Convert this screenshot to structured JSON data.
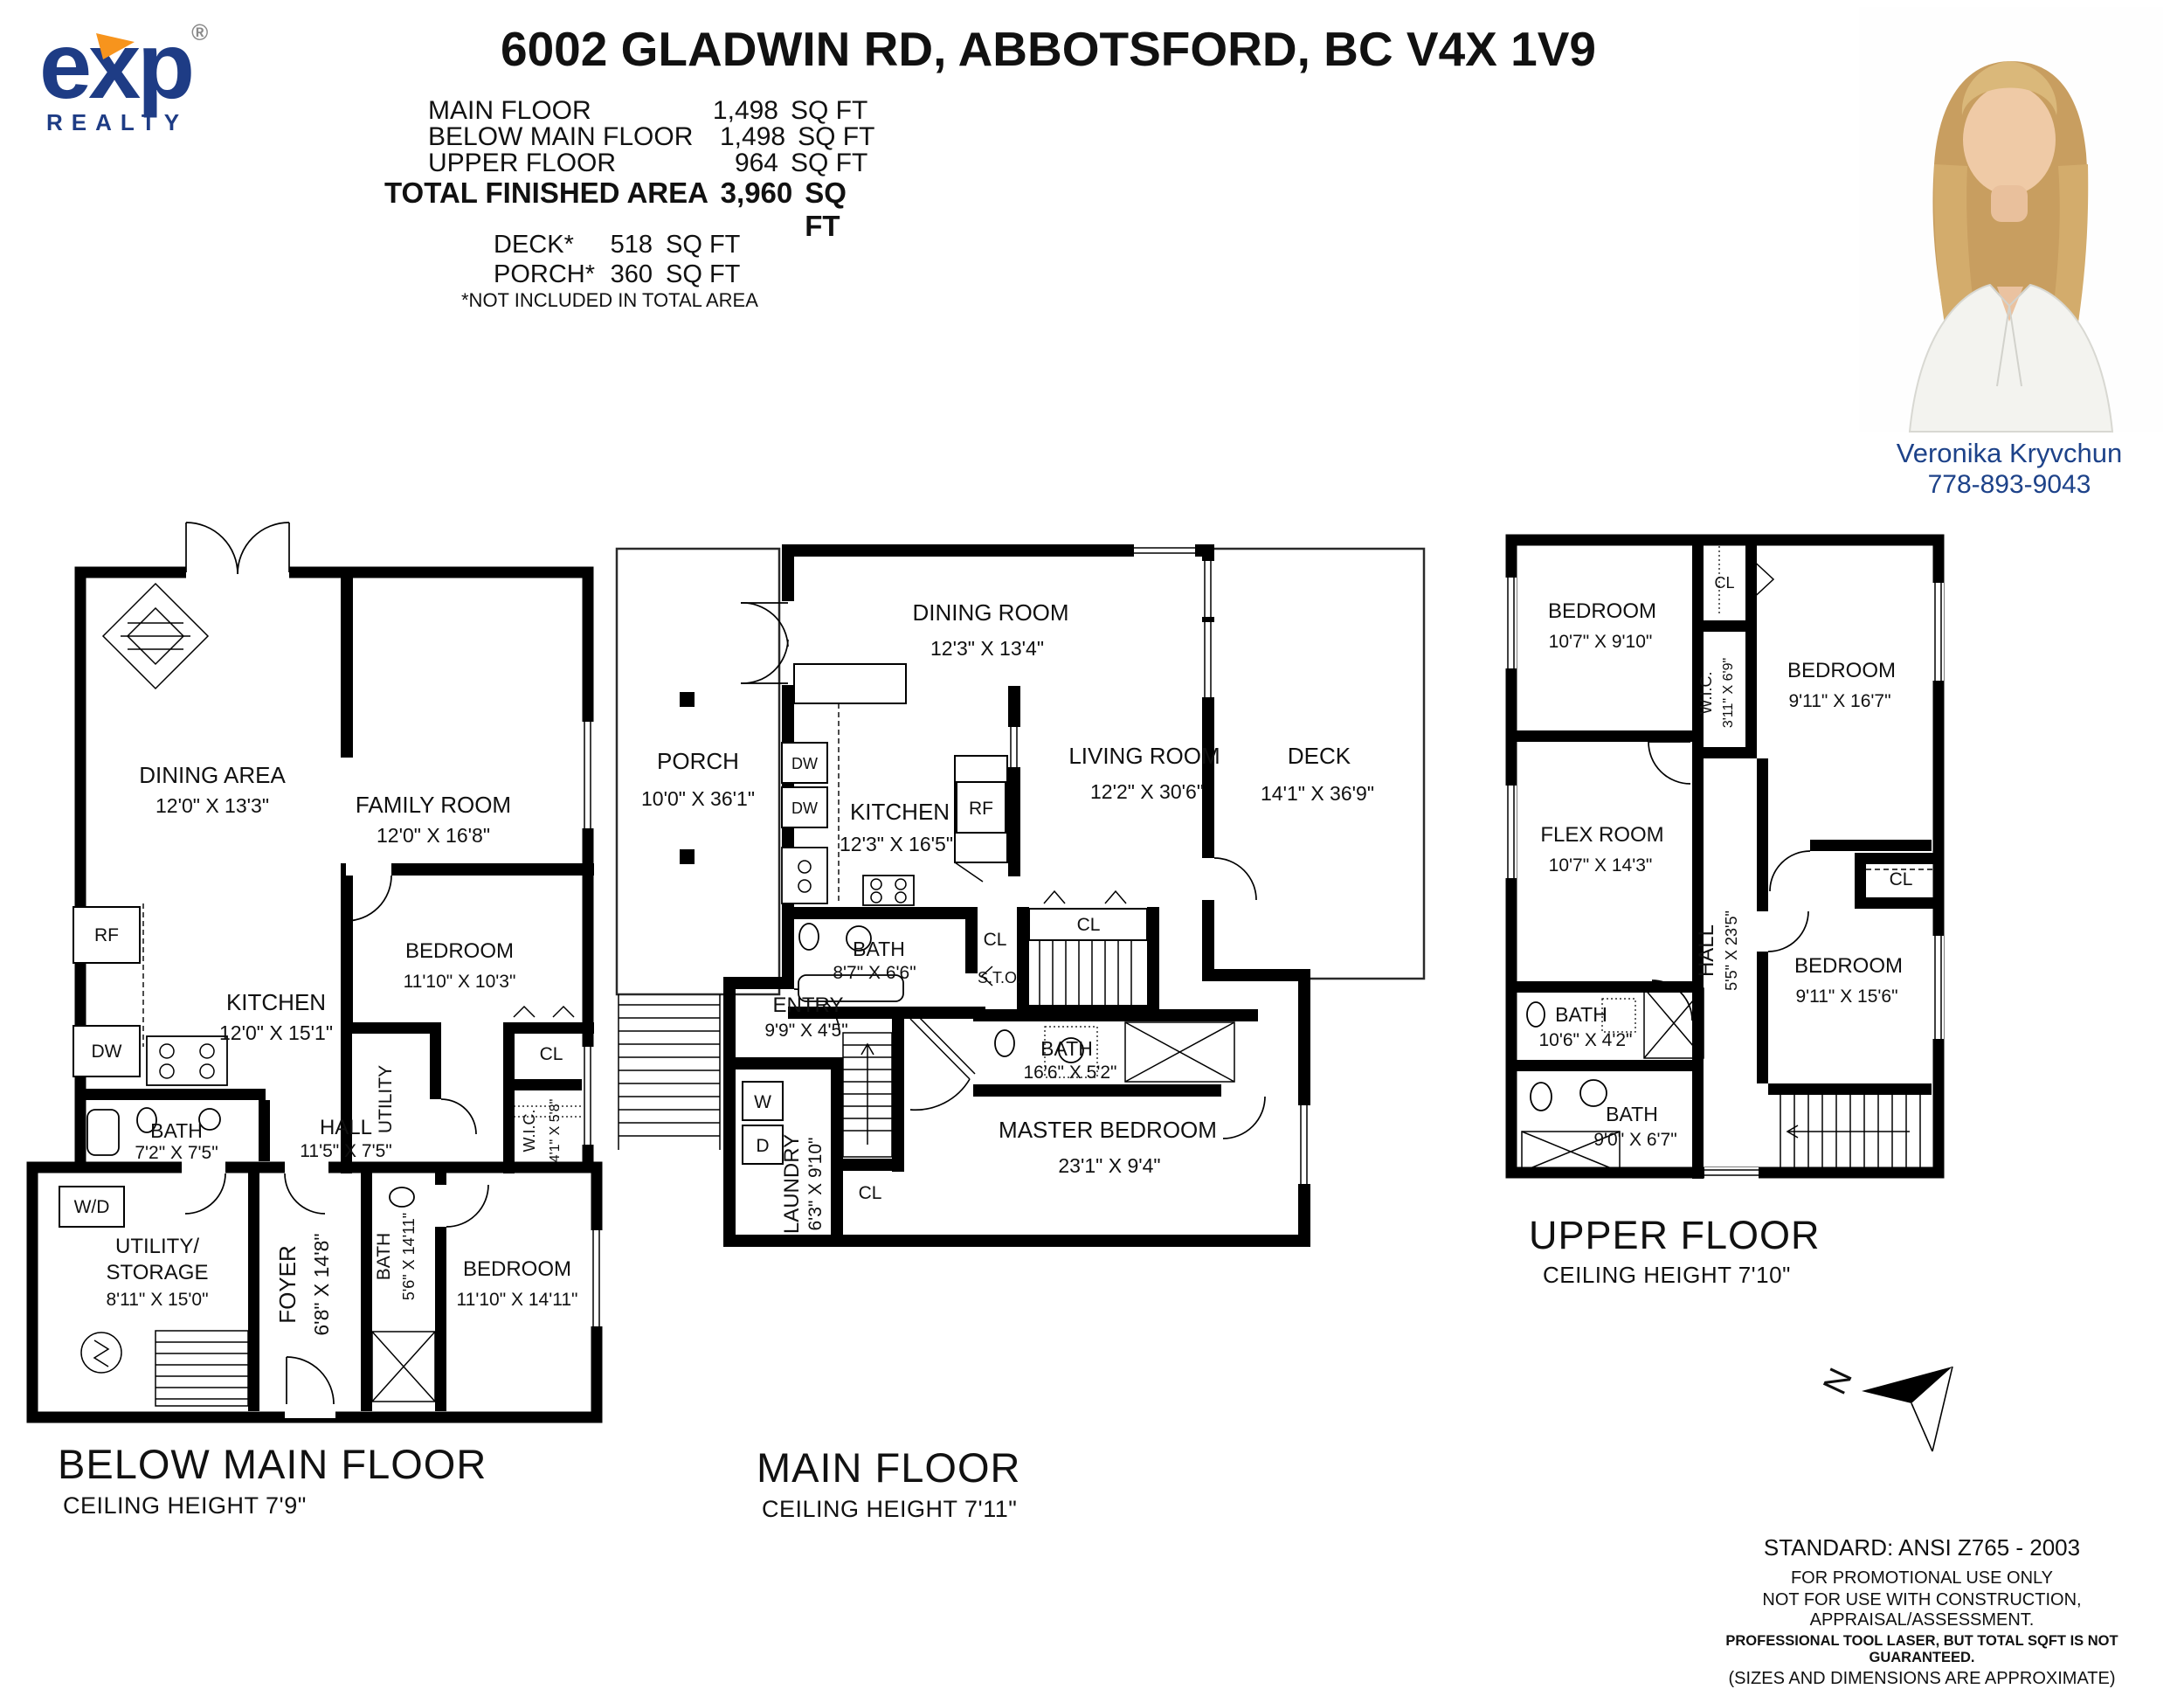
{
  "header": {
    "title": "6002 GLADWIN RD, ABBOTSFORD, BC V4X 1V9",
    "logo": {
      "e": "e",
      "x": "x",
      "p": "p",
      "reg": "®",
      "realty": "REALTY",
      "navy": "#1e3c85",
      "orange": "#f7941d"
    },
    "areas": [
      {
        "label": "MAIN FLOOR",
        "value": "1,498",
        "unit": "SQ FT"
      },
      {
        "label": "BELOW MAIN FLOOR",
        "value": "1,498",
        "unit": "SQ FT"
      },
      {
        "label": "UPPER FLOOR",
        "value": "964",
        "unit": "SQ FT"
      }
    ],
    "total": {
      "label": "TOTAL FINISHED AREA",
      "value": "3,960",
      "unit": "SQ FT"
    },
    "extras": [
      {
        "label": "DECK*",
        "value": "518",
        "unit": "SQ FT"
      },
      {
        "label": "PORCH*",
        "value": "360",
        "unit": "SQ FT"
      }
    ],
    "note": "*NOT INCLUDED IN TOTAL AREA"
  },
  "agent": {
    "name": "Veronika Kryvchun",
    "phone": "778-893-9043",
    "text_color": "#1d4289"
  },
  "floors": {
    "below": {
      "title": "BELOW MAIN FLOOR",
      "ceiling": "CEILING HEIGHT   7'9\"",
      "rooms": {
        "dining": {
          "name": "DINING AREA",
          "dims": "12'0\" X 13'3\""
        },
        "family": {
          "name": "FAMILY ROOM",
          "dims": "12'0\" X 16'8\""
        },
        "kitchen": {
          "name": "KITCHEN",
          "dims": "12'0\" X 15'1\""
        },
        "bedroom1": {
          "name": "BEDROOM",
          "dims": "11'10\" X 10'3\""
        },
        "bath1": {
          "name": "BATH",
          "dims": "7'2\" X 7'5\""
        },
        "hall": {
          "name": "HALL",
          "dims": "11'5\" X 7'5\""
        },
        "utility": {
          "name": "UTILITY"
        },
        "cl": {
          "name": "CL"
        },
        "wic": {
          "name": "W.I.C.",
          "dims": "4'1\" X 5'8\""
        },
        "wd": {
          "name": "W/D"
        },
        "storage": {
          "line1": "UTILITY/",
          "line2": "STORAGE",
          "dims": "8'11\" X 15'0\""
        },
        "foyer": {
          "name": "FOYER",
          "dims": "6'8\" X 14'8\""
        },
        "bath2": {
          "name": "BATH",
          "dims": "5'6\" X 14'11\""
        },
        "bedroom2": {
          "name": "BEDROOM",
          "dims": "11'10\" X 14'11\""
        },
        "rf": {
          "name": "RF"
        },
        "dw": {
          "name": "DW"
        }
      }
    },
    "main": {
      "title": "MAIN FLOOR",
      "ceiling": "CEILING HEIGHT   7'11\"",
      "rooms": {
        "porch": {
          "name": "PORCH",
          "dims": "10'0\" X 36'1\""
        },
        "dining": {
          "name": "DINING ROOM",
          "dims": "12'3\" X 13'4\""
        },
        "kitchen": {
          "name": "KITCHEN",
          "dims": "12'3\" X 16'5\""
        },
        "living": {
          "name": "LIVING ROOM",
          "dims": "12'2\" X 30'6\""
        },
        "deck": {
          "name": "DECK",
          "dims": "14'1\" X 36'9\""
        },
        "bath1": {
          "name": "BATH",
          "dims": "8'7\" X 6'6\""
        },
        "cl1": {
          "name": "CL"
        },
        "cl2": {
          "name": "CL"
        },
        "cl3": {
          "name": "CL"
        },
        "sto": {
          "name": "S.T.O."
        },
        "entry": {
          "name": "ENTRY",
          "dims": "9'9\" X 4'5\""
        },
        "laundry": {
          "name": "LAUNDRY",
          "dims": "6'3\" X 9'10\""
        },
        "w": {
          "name": "W"
        },
        "d": {
          "name": "D"
        },
        "bath2": {
          "name": "BATH",
          "dims": "16'6\" X 5'2\""
        },
        "master": {
          "name": "MASTER BEDROOM",
          "dims": "23'1\" X 9'4\""
        },
        "dw1": {
          "name": "DW"
        },
        "dw2": {
          "name": "DW"
        },
        "rf": {
          "name": "RF"
        }
      }
    },
    "upper": {
      "title": "UPPER FLOOR",
      "ceiling": "CEILING HEIGHT   7'10\"",
      "rooms": {
        "bedroom1": {
          "name": "BEDROOM",
          "dims": "10'7\" X 9'10\""
        },
        "cl1": {
          "name": "CL"
        },
        "wic": {
          "name": "W.I.C.",
          "dims": "3'11\" X 6'9\""
        },
        "bedroom2": {
          "name": "BEDROOM",
          "dims": "9'11\" X 16'7\""
        },
        "flex": {
          "name": "FLEX ROOM",
          "dims": "10'7\" X 14'3\""
        },
        "hall": {
          "name": "HALL",
          "dims": "5'5\" X 23'5\""
        },
        "cl2": {
          "name": "CL"
        },
        "bath1": {
          "name": "BATH",
          "dims": "10'6\" X 4'2\""
        },
        "bath2": {
          "name": "BATH",
          "dims": "9'0\" X 6'7\""
        },
        "bedroom3": {
          "name": "BEDROOM",
          "dims": "9'11\" X 15'6\""
        }
      }
    }
  },
  "compass": {
    "label": "N"
  },
  "disclaimer": {
    "line1": "STANDARD: ANSI  Z765 - 2003",
    "line2": "FOR PROMOTIONAL USE ONLY",
    "line3": "NOT FOR USE WITH CONSTRUCTION, APPRAISAL/ASSESSMENT.",
    "line4": "PROFESSIONAL TOOL LASER, BUT TOTAL SQFT IS NOT GUARANTEED.",
    "line5": "(SIZES AND DIMENSIONS ARE APPROXIMATE)"
  }
}
